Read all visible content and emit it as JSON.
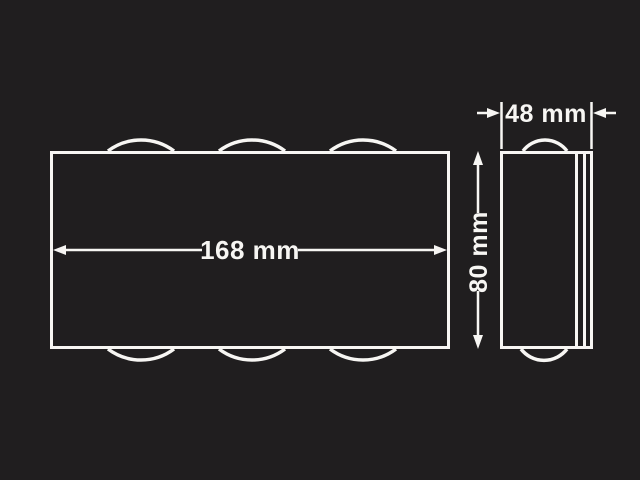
{
  "theme": {
    "background": "#201e1f",
    "ink": "#f7f6f3"
  },
  "diagram": {
    "front_view": {
      "width_label": "168 mm"
    },
    "side_view": {
      "depth_label": "48 mm",
      "height_label": "80 mm"
    }
  }
}
